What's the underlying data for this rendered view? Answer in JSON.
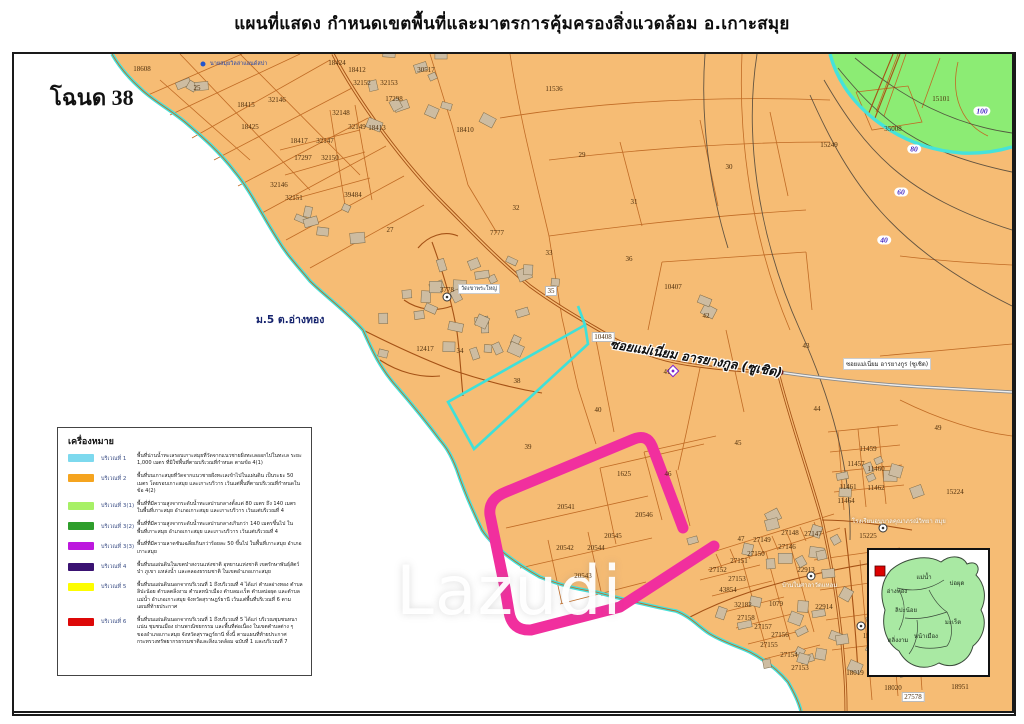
{
  "title": "แผนที่แสดง กำหนดเขตพื้นที่และมาตรการคุ้มครองสิ่งแวดล้อม อ.เกาะสมุย",
  "chanote_label": "โฉนด 38",
  "watermark": "Lazudi",
  "map": {
    "village_label": "ม.5 ต.อ่างทอง",
    "road_label_big": "ซอยแม่เนี่ยม อารยางกูล (ซูเชิด)",
    "road_label_small": "ซอยแม่เนี่ยม อารยางกูร (ซูเชิด)",
    "temple_label": "วัดเขาพระใหญ่",
    "resort_label": "นายสมุยวิลล่าแอนด์สปา",
    "community_label": "บ้านในศาลาวัดแหลม",
    "school_label": "โรงเรียนอนุบาลคุณาภรณ์วิทยา สมุย",
    "parcel_labels": [
      {
        "t": "18608",
        "x": 142,
        "y": 69
      },
      {
        "t": "25",
        "x": 197,
        "y": 88
      },
      {
        "t": "18424",
        "x": 337,
        "y": 63
      },
      {
        "t": "18412",
        "x": 357,
        "y": 70
      },
      {
        "t": "32152",
        "x": 362,
        "y": 83
      },
      {
        "t": "32153",
        "x": 389,
        "y": 83
      },
      {
        "t": "17298",
        "x": 394,
        "y": 99
      },
      {
        "t": "30517",
        "x": 426,
        "y": 70
      },
      {
        "t": "11536",
        "x": 554,
        "y": 89
      },
      {
        "t": "18415",
        "x": 246,
        "y": 105
      },
      {
        "t": "32146",
        "x": 277,
        "y": 100
      },
      {
        "t": "18425",
        "x": 250,
        "y": 127
      },
      {
        "t": "32148",
        "x": 341,
        "y": 113
      },
      {
        "t": "32149",
        "x": 357,
        "y": 127
      },
      {
        "t": "18413",
        "x": 377,
        "y": 128
      },
      {
        "t": "18417",
        "x": 299,
        "y": 141
      },
      {
        "t": "32147",
        "x": 325,
        "y": 141
      },
      {
        "t": "17297",
        "x": 303,
        "y": 158
      },
      {
        "t": "32150",
        "x": 330,
        "y": 158
      },
      {
        "t": "32146",
        "x": 279,
        "y": 185
      },
      {
        "t": "32151",
        "x": 294,
        "y": 198
      },
      {
        "t": "39484",
        "x": 353,
        "y": 195
      },
      {
        "t": "27",
        "x": 390,
        "y": 230
      },
      {
        "t": "18410",
        "x": 465,
        "y": 130
      },
      {
        "t": "29",
        "x": 582,
        "y": 155
      },
      {
        "t": "31",
        "x": 634,
        "y": 202
      },
      {
        "t": "32",
        "x": 516,
        "y": 208
      },
      {
        "t": "30",
        "x": 729,
        "y": 167
      },
      {
        "t": "15249",
        "x": 829,
        "y": 145
      },
      {
        "t": "35008",
        "x": 893,
        "y": 129
      },
      {
        "t": "15101",
        "x": 941,
        "y": 99
      },
      {
        "t": "7777",
        "x": 497,
        "y": 233
      },
      {
        "t": "33",
        "x": 549,
        "y": 253
      },
      {
        "t": "36",
        "x": 629,
        "y": 259
      },
      {
        "t": "35",
        "x": 551,
        "y": 291,
        "c": "wbox"
      },
      {
        "t": "10407",
        "x": 673,
        "y": 287
      },
      {
        "t": "42",
        "x": 706,
        "y": 316
      },
      {
        "t": "10408",
        "x": 603,
        "y": 337,
        "c": "wbox"
      },
      {
        "t": "43",
        "x": 806,
        "y": 346
      },
      {
        "t": "41",
        "x": 667,
        "y": 372
      },
      {
        "t": "44",
        "x": 817,
        "y": 409
      },
      {
        "t": "45",
        "x": 738,
        "y": 443
      },
      {
        "t": "49",
        "x": 938,
        "y": 428
      },
      {
        "t": "15224",
        "x": 955,
        "y": 492
      },
      {
        "t": "40",
        "x": 598,
        "y": 410
      },
      {
        "t": "38",
        "x": 517,
        "y": 381
      },
      {
        "t": "39",
        "x": 528,
        "y": 447
      },
      {
        "t": "12417",
        "x": 425,
        "y": 349
      },
      {
        "t": "34",
        "x": 460,
        "y": 351
      },
      {
        "t": "3778",
        "x": 447,
        "y": 290
      },
      {
        "t": "1625",
        "x": 624,
        "y": 474
      },
      {
        "t": "46",
        "x": 668,
        "y": 474
      },
      {
        "t": "20541",
        "x": 566,
        "y": 507
      },
      {
        "t": "20546",
        "x": 644,
        "y": 515
      },
      {
        "t": "20545",
        "x": 613,
        "y": 536
      },
      {
        "t": "20542",
        "x": 565,
        "y": 548
      },
      {
        "t": "20544",
        "x": 596,
        "y": 548
      },
      {
        "t": "20543",
        "x": 583,
        "y": 576
      },
      {
        "t": "11459",
        "x": 868,
        "y": 449
      },
      {
        "t": "11457",
        "x": 856,
        "y": 464
      },
      {
        "t": "11460",
        "x": 876,
        "y": 469
      },
      {
        "t": "11461",
        "x": 848,
        "y": 487
      },
      {
        "t": "11462",
        "x": 876,
        "y": 488
      },
      {
        "t": "11464",
        "x": 846,
        "y": 501
      },
      {
        "t": "15225",
        "x": 868,
        "y": 536
      },
      {
        "t": "47",
        "x": 741,
        "y": 539
      },
      {
        "t": "27149",
        "x": 762,
        "y": 540
      },
      {
        "t": "27148",
        "x": 790,
        "y": 533
      },
      {
        "t": "27147",
        "x": 813,
        "y": 534
      },
      {
        "t": "27146",
        "x": 787,
        "y": 547
      },
      {
        "t": "27150",
        "x": 756,
        "y": 554
      },
      {
        "t": "27151",
        "x": 739,
        "y": 561
      },
      {
        "t": "27152",
        "x": 718,
        "y": 570
      },
      {
        "t": "27153",
        "x": 737,
        "y": 579
      },
      {
        "t": "43854",
        "x": 728,
        "y": 590
      },
      {
        "t": "32182",
        "x": 743,
        "y": 605
      },
      {
        "t": "1079",
        "x": 776,
        "y": 604
      },
      {
        "t": "22913",
        "x": 806,
        "y": 570
      },
      {
        "t": "22914",
        "x": 824,
        "y": 607
      },
      {
        "t": "27158",
        "x": 746,
        "y": 618
      },
      {
        "t": "27157",
        "x": 763,
        "y": 627
      },
      {
        "t": "27156",
        "x": 780,
        "y": 635
      },
      {
        "t": "27155",
        "x": 769,
        "y": 645
      },
      {
        "t": "27154",
        "x": 789,
        "y": 655
      },
      {
        "t": "27153",
        "x": 800,
        "y": 668
      },
      {
        "t": "18019",
        "x": 855,
        "y": 673
      },
      {
        "t": "151",
        "x": 868,
        "y": 636
      },
      {
        "t": "18020",
        "x": 893,
        "y": 688
      },
      {
        "t": "27578",
        "x": 913,
        "y": 697,
        "c": "wbox"
      },
      {
        "t": "18951",
        "x": 960,
        "y": 687
      }
    ],
    "contour_labels": [
      {
        "t": "100",
        "x": 982,
        "y": 111
      },
      {
        "t": "80",
        "x": 914,
        "y": 149
      },
      {
        "t": "60",
        "x": 901,
        "y": 192
      },
      {
        "t": "40",
        "x": 884,
        "y": 240
      }
    ]
  },
  "legend": {
    "title": "เครื่องหมาย",
    "rows": [
      {
        "zone": "บริเวณที่ 1",
        "color": "#7dd9ee",
        "desc": "พื้นที่น่านน้ำทะเลรอบเกาะสมุยที่วัดจากแนวชายฝั่งทะเลออกไปในทะเล ระยะ 1,000 เมตร ที่มิใช่พื้นที่ตามบริเวณที่กำหนด ตามข้อ 4(1)"
      },
      {
        "zone": "บริเวณที่ 2",
        "color": "#f5a41f",
        "desc": "พื้นที่บนเกาะสมุยที่วัดจากแนวชายฝั่งทะเลเข้าไปในแผ่นดิน เป็นระยะ 50 เมตร โดยรอบเกาะสมุย และเกาะบริวาร เว้นแต่พื้นที่ตามบริเวณที่กำหนดในข้อ 4(2)"
      },
      {
        "zone": "บริเวณที่ 3(1)",
        "color": "#a7f066",
        "desc": "พื้นที่ที่มีความสูงจากระดับน้ำทะเลปานกลางตั้งแต่ 80 เมตร ถึง 140 เมตร ในพื้นที่เกาะสมุย อำเภอเกาะสมุย และเกาะบริวาร เว้นแต่บริเวณที่ 4"
      },
      {
        "zone": "บริเวณที่ 3(2)",
        "color": "#2e9e2b",
        "desc": "พื้นที่ที่มีความสูงจากระดับน้ำทะเลปานกลางเกินกว่า 140 เมตรขึ้นไป ในพื้นที่เกาะสมุย อำเภอเกาะสมุย และเกาะบริวาร เว้นแต่บริเวณที่ 4"
      },
      {
        "zone": "บริเวณที่ 3(3)",
        "color": "#bd18de",
        "desc": "พื้นที่ที่มีความลาดชันเฉลี่ยเกินกว่าร้อยละ 50 ขึ้นไป ในพื้นที่เกาะสมุย อำเภอเกาะสมุย"
      },
      {
        "zone": "บริเวณที่ 4",
        "color": "#3a1272",
        "desc": "พื้นที่บนแผ่นดินในเขตป่าสงวนแห่งชาติ อุทยานแห่งชาติ เขตรักษาพันธุ์สัตว์ป่า ภูเขา แหล่งน้ำ และคลองธรรมชาติ ในเขตอำเภอเกาะสมุย"
      },
      {
        "zone": "บริเวณที่ 5",
        "color": "#fdfd00",
        "desc": "พื้นที่บนแผ่นดินนอกจากบริเวณที่ 1 ถึงบริเวณที่ 4 ได้แก่ ตำบลอ่างทอง ตำบลลิปะน้อย ตำบลตลิ่งงาม ตำบลหน้าเมือง ตำบลมะเร็ต ตำบลบ่อผุด และตำบลแม่น้ำ อำเภอเกาะสมุย จังหวัดสุราษฎร์ธานี เว้นแต่พื้นที่บริเวณที่ 6 ตามแผนที่ท้ายประกาศ"
      },
      {
        "zone": "บริเวณที่ 6",
        "color": "#dd0808",
        "desc": "พื้นที่บนแผ่นดินนอกจากบริเวณที่ 1 ถึงบริเวณที่ 5 ได้แก่ บริเวณชุมชนหนาแน่น ชุมชนเมือง ย่านพาณิชยกรรม และพื้นที่ต่อเนื่อง ในเขตตำบลต่าง ๆ ของอำเภอเกาะสมุย จังหวัดสุราษฎร์ธานี ทั้งนี้ ตามแผนที่ท้ายประกาศกระทรวงทรัพยากรธรรมชาติและสิ่งแวดล้อม ฉบับที่ 1 และบริเวณที่ 7"
      }
    ]
  },
  "inset": {
    "labels": [
      {
        "t": "แม่น้ำ",
        "x": 55,
        "y": 27
      },
      {
        "t": "บ่อผุด",
        "x": 88,
        "y": 33
      },
      {
        "t": "อ่างทอง",
        "x": 28,
        "y": 41
      },
      {
        "t": "ลิปะน้อย",
        "x": 37,
        "y": 60
      },
      {
        "t": "มะเร็ต",
        "x": 84,
        "y": 72
      },
      {
        "t": "ตลิ่งงาม",
        "x": 29,
        "y": 90
      },
      {
        "t": "หน้าเมือง",
        "x": 57,
        "y": 86
      }
    ]
  },
  "colors": {
    "land": "#f6bc74",
    "sea": "#ffffff",
    "coast": "#45e2db",
    "green_zone": "#8cec74",
    "highlight_pink": "#f12f9e",
    "parcel_line": "#c06b25",
    "road": "#a55216"
  }
}
